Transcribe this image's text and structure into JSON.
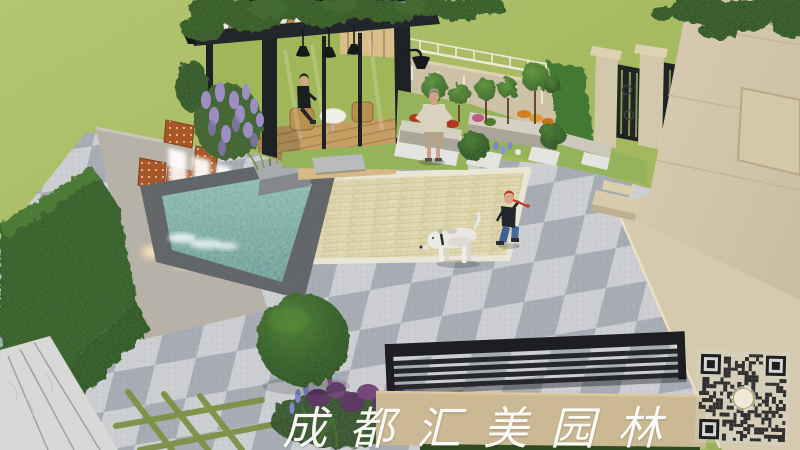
{
  "scene": {
    "description": "3D landscape-architecture rendering of a villa courtyard garden with pavilion, waterfall pool and stone plaza",
    "watermark": {
      "text": "成都汇美园林",
      "color": "#ffffff"
    },
    "qr_code": {
      "present": true,
      "center_logo": true
    },
    "palette": {
      "lawn": "#a3b95c",
      "hedge": "#2e5424",
      "paving_light": "#ccced2",
      "paving_dark": "#a7acb4",
      "patio_cream": "#ded6ae",
      "pool_water": "#6fa59c",
      "corten_panel": "#a8572a",
      "villa_facade": "#d8cbae",
      "pergola_frame": "#202327",
      "deck_wood": "#c49e63",
      "bench_black": "#1c1e21"
    }
  }
}
